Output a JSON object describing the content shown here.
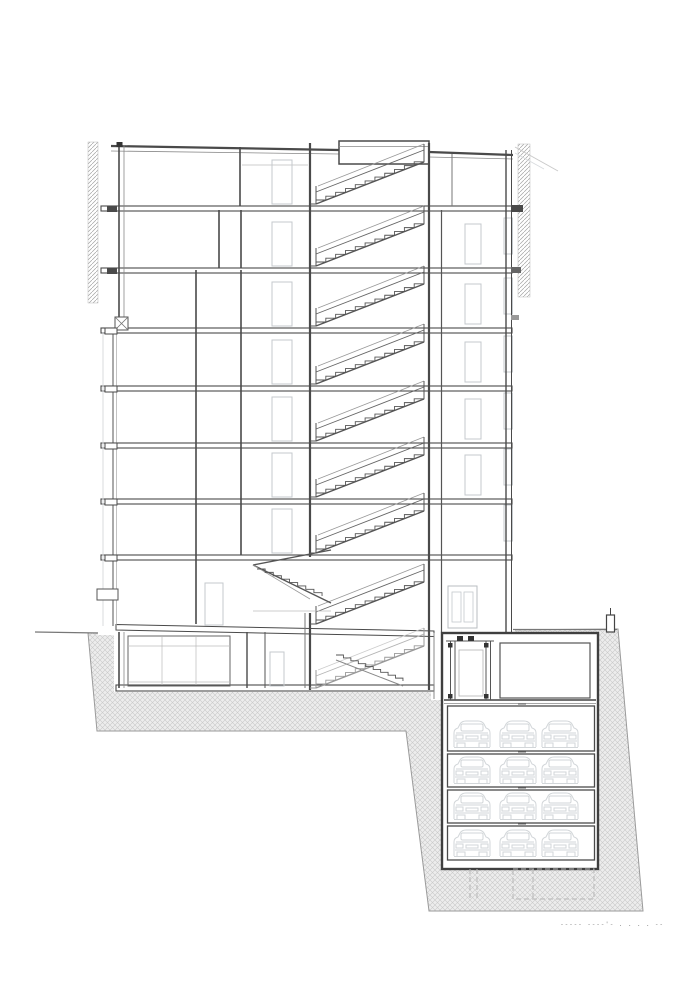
{
  "page": {
    "background": "#ffffff",
    "kind": "architectural cross-section drawing"
  },
  "caption": {
    "marks": "----- ----'- . . . . --"
  },
  "colors": {
    "dark": "#3f3f3f",
    "wall": "#4a4a4a",
    "mid": "#777777",
    "soft": "#999999",
    "light": "#c4c9cd",
    "faint": "#d8dbde",
    "hatch_line": "#c9c9c9",
    "hatch_bg": "#ededed",
    "party_line": "#a3a3a3",
    "ground_edge": "#9a9a9a",
    "caption_color": "#8a8a8a",
    "car": "#d2d6d9",
    "white": "#ffffff"
  },
  "geometry": {
    "canvas": {
      "w": 700,
      "h": 991
    },
    "floors": [
      206,
      268,
      328,
      386,
      443,
      499,
      555
    ],
    "stair_stories": [
      206,
      268,
      328,
      386,
      443,
      499,
      555,
      626,
      690
    ],
    "door_floors_left": [
      206,
      268,
      328,
      386,
      443,
      499,
      555
    ],
    "door_floors_right": [
      268,
      328,
      386,
      443,
      499
    ],
    "window_floors_right": [
      268,
      328,
      386,
      443,
      499,
      555
    ],
    "slab_nose_floors": [
      328,
      386,
      443,
      499,
      555
    ],
    "slab_block_floors": [
      206,
      268
    ],
    "ground_outline": "88,633 618,629 643,911 429,911 406,731 97,731",
    "parking": {
      "levels": [
        {
          "y": 706,
          "h": 45
        },
        {
          "y": 754,
          "h": 33
        },
        {
          "y": 790,
          "h": 33
        },
        {
          "y": 826,
          "h": 34
        }
      ],
      "cars_x": [
        452,
        498,
        540
      ],
      "cars_per_level": 3
    }
  }
}
